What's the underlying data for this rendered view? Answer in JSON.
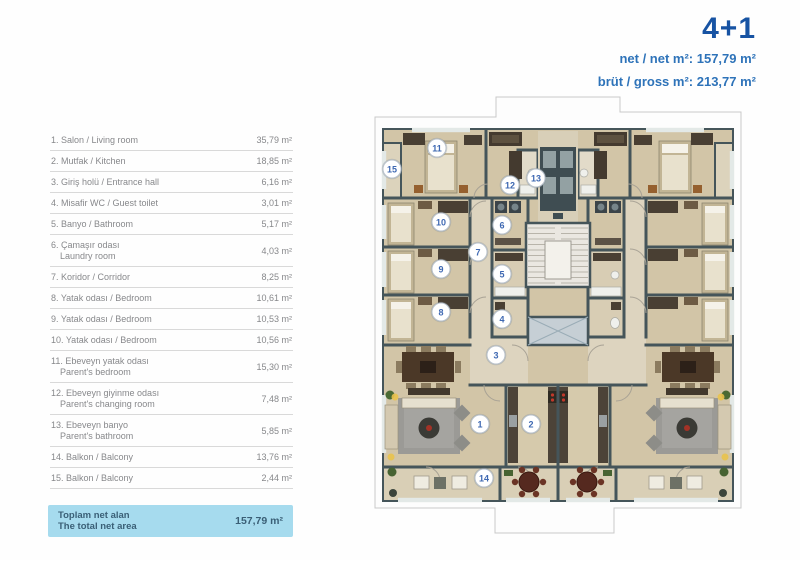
{
  "header": {
    "apartment_type": "4+1",
    "net_line": "net / net m²: 157,79 m²",
    "gross_line": "brüt / gross m²: 213,77 m²"
  },
  "room_table": {
    "rows": [
      {
        "label": [
          "1. Salon / Living room"
        ],
        "area": "35,79 m²"
      },
      {
        "label": [
          "2. Mutfak / Kitchen"
        ],
        "area": "18,85 m²"
      },
      {
        "label": [
          "3. Giriş holü / Entrance hall"
        ],
        "area": "6,16 m²"
      },
      {
        "label": [
          "4. Misafir WC / Guest toilet"
        ],
        "area": "3,01 m²"
      },
      {
        "label": [
          "5. Banyo / Bathroom"
        ],
        "area": "5,17 m²"
      },
      {
        "label": [
          "6. Çamaşır odası",
          "Laundry room"
        ],
        "area": "4,03 m²"
      },
      {
        "label": [
          "7. Koridor / Corridor"
        ],
        "area": "8,25 m²"
      },
      {
        "label": [
          "8. Yatak odası / Bedroom"
        ],
        "area": "10,61 m²"
      },
      {
        "label": [
          "9. Yatak odası / Bedroom"
        ],
        "area": "10,53 m²"
      },
      {
        "label": [
          "10. Yatak odası / Bedroom"
        ],
        "area": "10,56 m²"
      },
      {
        "label": [
          "11. Ebeveyn yatak odası",
          "Parent's bedroom"
        ],
        "area": "15,30 m²"
      },
      {
        "label": [
          "12. Ebeveyn giyinme odası",
          "Parent's changing room"
        ],
        "area": "7,48 m²"
      },
      {
        "label": [
          "13. Ebeveyn banyo",
          "Parent's bathroom"
        ],
        "area": "5,85 m²"
      },
      {
        "label": [
          "14. Balkon / Balcony"
        ],
        "area": "13,76 m²"
      },
      {
        "label": [
          "15. Balkon / Balcony"
        ],
        "area": "2,44 m²"
      }
    ],
    "total": {
      "label": [
        "Toplam net alan",
        "The total net area"
      ],
      "area": "157,79 m²"
    }
  },
  "plan": {
    "markers": [
      {
        "n": "1",
        "x": 112,
        "y": 329
      },
      {
        "n": "2",
        "x": 163,
        "y": 329
      },
      {
        "n": "3",
        "x": 128,
        "y": 260
      },
      {
        "n": "4",
        "x": 134,
        "y": 224
      },
      {
        "n": "5",
        "x": 134,
        "y": 179
      },
      {
        "n": "6",
        "x": 134,
        "y": 130
      },
      {
        "n": "7",
        "x": 110,
        "y": 157
      },
      {
        "n": "8",
        "x": 73,
        "y": 217
      },
      {
        "n": "9",
        "x": 73,
        "y": 174
      },
      {
        "n": "10",
        "x": 73,
        "y": 127
      },
      {
        "n": "11",
        "x": 69,
        "y": 53
      },
      {
        "n": "12",
        "x": 142,
        "y": 90
      },
      {
        "n": "13",
        "x": 168,
        "y": 83
      },
      {
        "n": "14",
        "x": 116,
        "y": 383
      },
      {
        "n": "15",
        "x": 24,
        "y": 74
      }
    ],
    "colors": {
      "accent_blue": "#1753a3",
      "sub_blue": "#2e73b9",
      "table_text": "#87888b",
      "total_bg": "#a6dbee",
      "total_text": "#3a5f76",
      "wall": "#45555a",
      "floor_tan": "#d2c5a7",
      "marker_blue": "#3e68b2"
    }
  }
}
